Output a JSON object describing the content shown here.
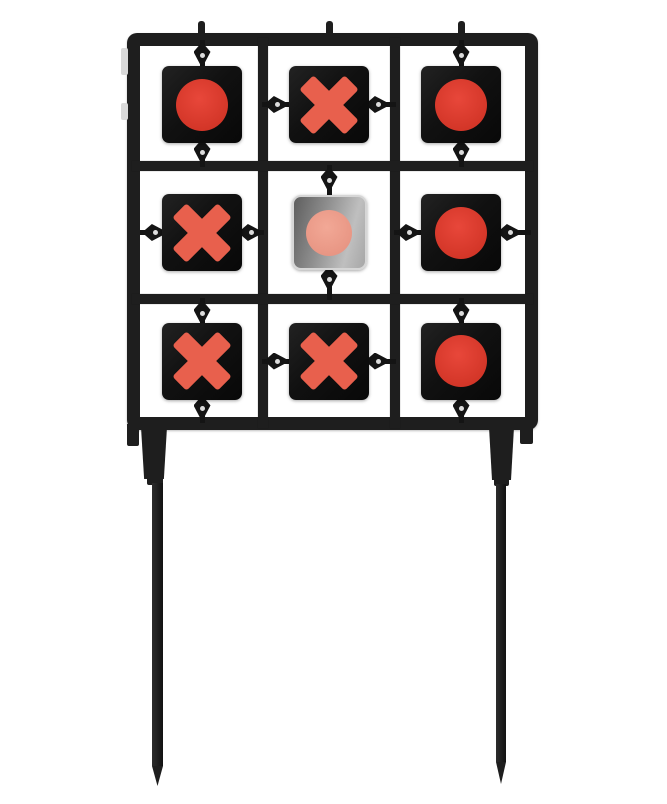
{
  "image": {
    "subject": "steel tic-tac-toe spinner shooting target on two ground stakes",
    "background": "#ffffff"
  },
  "colors": {
    "frame": "#1e1e1e",
    "hardware": "#141414",
    "plate_black": "#111111",
    "plate_steel_edge": "#d6d6d6",
    "x_symbol": "#e8604d",
    "o_symbol": "#d23527",
    "o_symbol_light": "#e8473a",
    "o_symbol_pink": "#e79482",
    "o_symbol_pink_light": "#f2a896",
    "mount_tab": "#d9d9d9"
  },
  "board": {
    "rows": 3,
    "cols": 3,
    "cells": [
      {
        "row": 0,
        "col": 0,
        "symbol": "O",
        "plate": "black",
        "pivot": "vertical"
      },
      {
        "row": 0,
        "col": 1,
        "symbol": "X",
        "plate": "black",
        "pivot": "horizontal"
      },
      {
        "row": 0,
        "col": 2,
        "symbol": "O",
        "plate": "black",
        "pivot": "vertical"
      },
      {
        "row": 1,
        "col": 0,
        "symbol": "X",
        "plate": "black",
        "pivot": "horizontal"
      },
      {
        "row": 1,
        "col": 1,
        "symbol": "O",
        "plate": "steel",
        "pivot": "vertical"
      },
      {
        "row": 1,
        "col": 2,
        "symbol": "O",
        "plate": "black",
        "pivot": "horizontal"
      },
      {
        "row": 2,
        "col": 0,
        "symbol": "X",
        "plate": "black",
        "pivot": "vertical"
      },
      {
        "row": 2,
        "col": 1,
        "symbol": "X",
        "plate": "black",
        "pivot": "horizontal"
      },
      {
        "row": 2,
        "col": 2,
        "symbol": "O",
        "plate": "black",
        "pivot": "vertical"
      }
    ]
  },
  "legs": {
    "count": 2
  }
}
